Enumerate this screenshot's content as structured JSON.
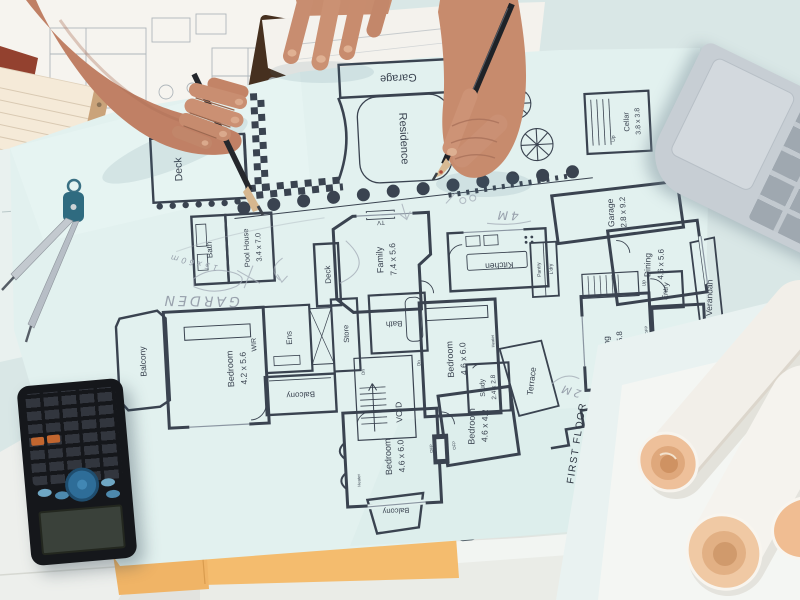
{
  "meta": {
    "alt": "Overhead photo of two people reviewing architectural house blueprints on a desk with calculator, laptop, drafting compass, pencils and rolled plans"
  },
  "site_plan": {
    "garage": "Garage",
    "residence": "Residence",
    "deck": "Deck"
  },
  "floor_plan": {
    "sheet_title": "FIRST FLOOR",
    "rooms": {
      "bath_pool": {
        "name": "Bath"
      },
      "pool_house": {
        "name": "Pool House",
        "dims": "3.4 x 7.0"
      },
      "deck_family": {
        "name": "Deck"
      },
      "family": {
        "name": "Family",
        "dims": "7.4 x 5.6"
      },
      "kitchen": {
        "name": "Kitchen"
      },
      "pantry": {
        "name": "Pantry"
      },
      "laundry": {
        "name": "L'dry"
      },
      "garage": {
        "name": "Garage",
        "dims": "2.8 x 9.2"
      },
      "dining": {
        "name": "Dining",
        "dims": "4.6 x 5.6"
      },
      "cellar": {
        "name": "Cellar",
        "dims": "3.8 x 3.8"
      },
      "living": {
        "name": "Living",
        "dims": "4.6 x 5.8"
      },
      "study_ground": {
        "name": "Study",
        "dims": "4.6 x 4.2"
      },
      "entry": {
        "name": "Entry"
      },
      "verandah": {
        "name": "Verandah"
      },
      "balcony_left": {
        "name": "Balcony"
      },
      "wir": {
        "name": "WIR"
      },
      "bedroom_master": {
        "name": "Bedroom",
        "dims": "4.2 x 5.6"
      },
      "ensuite": {
        "name": "Ens"
      },
      "store": {
        "name": "Store"
      },
      "bath_first": {
        "name": "Bath"
      },
      "balcony_mid": {
        "name": "Balcony"
      },
      "void": {
        "name": "VOID"
      },
      "bedroom_2": {
        "name": "Bedroom",
        "dims": "4.6 x 6.0"
      },
      "study_first": {
        "name": "Study",
        "dims": "2.4 x 2.8"
      },
      "terrace": {
        "name": "Terrace"
      },
      "bedroom_3": {
        "name": "Bedroom",
        "dims": "4.6 x 6.0"
      },
      "bedroom_4": {
        "name": "Bedroom",
        "dims": "4.6 x 4.2"
      },
      "balcony_bottom": {
        "name": "Balcony"
      }
    },
    "annotations": {
      "up": "Up",
      "dn": "Dn",
      "ofp": "OFP",
      "heater": "Heater",
      "tv": "TV"
    }
  },
  "handwriting": {
    "garden": "GARDEN",
    "offset_note": "15x60m",
    "four_m": "4M",
    "two_m": "2M"
  },
  "objects": {
    "calculator": "scientific-calculator",
    "laptop": "laptop-keyboard-corner",
    "compass": "drafting-compass",
    "pencil_left": "pencil",
    "pencil_right": "pencil",
    "rolls": "rolled-blueprints",
    "sticky_notes": "orange-sticky-notes",
    "notepad": "lined-notepad",
    "clipboard": "clipboard"
  },
  "colors": {
    "desk": "#d9e7e6",
    "blueprint_sheet": "#e2f1ef",
    "plan_line": "#3a4350",
    "skin": "#c58568",
    "sticky_note": "#f0b466",
    "calculator_body": "#15171b",
    "calc_dpad": "#2e6d98",
    "calc_orange_key": "#c2662f",
    "laptop_silver": "#c7ced4",
    "roll_end_tan": "#eec09a"
  }
}
